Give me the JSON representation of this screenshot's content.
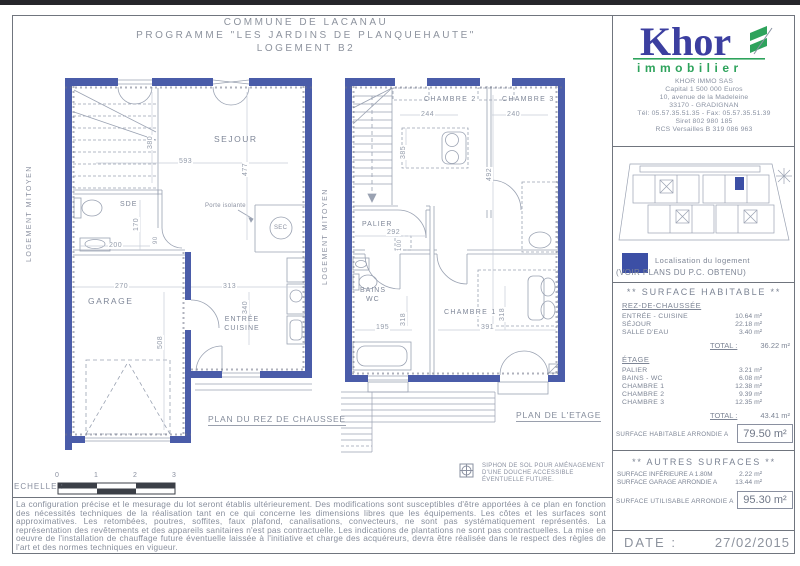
{
  "colors": {
    "wall_blue": "#4a5ca9",
    "logo_blue": "#3c3fa0",
    "logo_green": "#2ea35c",
    "localisation_blue": "#3c4fa5",
    "scale_dark": "#3b3f47"
  },
  "header": {
    "line1": "COMMUNE DE LACANAU",
    "line2": "PROGRAMME \"LES JARDINS DE PLANQUEHAUTE\"",
    "line3": "LOGEMENT B2"
  },
  "ground_plan": {
    "title": "PLAN DU REZ DE CHAUSSEE",
    "party_wall": "LOGEMENT MITOYEN",
    "rooms": {
      "sejour": "SEJOUR",
      "sde": "SDE",
      "garage": "GARAGE",
      "entree": "ENTRÉE",
      "cuisine": "CUISINE",
      "sec": "SEC"
    },
    "notes": {
      "porte_isolante": "Porte isolante"
    },
    "dims": {
      "d380": "380",
      "d593": "593",
      "d477": "477",
      "d170": "170",
      "d200": "200",
      "d90": "90",
      "d270": "270",
      "d313": "313",
      "d340": "340",
      "d508": "508"
    }
  },
  "floor_plan": {
    "title": "PLAN DE L'ETAGE",
    "party_wall": "LOGEMENT MITOYEN",
    "rooms": {
      "chambre1": "CHAMBRE 1",
      "chambre2": "CHAMBRE 2",
      "chambre3": "CHAMBRE 3",
      "palier": "PALIER",
      "bains": "BAINS",
      "wc": "WC"
    },
    "dims": {
      "d244": "244",
      "d240": "240",
      "d385": "385",
      "d492": "492",
      "d292": "292",
      "d100": "100",
      "d318": "318",
      "d195": "195",
      "d391": "391",
      "d318b": "318"
    }
  },
  "scale_bar": {
    "label": "ECHELLE :",
    "ticks": [
      "0",
      "1",
      "2",
      "3"
    ]
  },
  "siphon_note": {
    "line1": "SIPHON DE SOL POUR AMÉNAGEMENT",
    "line2": "D'UNE DOUCHE ACCESSIBLE",
    "line3": "ÉVENTUELLE  FUTURE."
  },
  "legal_text": "La configuration précise et le mesurage du lot seront établis ultérieurement. Des modifications sont susceptibles d'être apportées à ce plan en fonction des nécessités techniques de la réalisation tant en ce qui concerne les dimensions libres que les équipements. Les côtes et les surfaces sont approximatives. Les retombées, poutres, soffites, faux plafond, canalisations, convecteurs, ne sont pas systématiquement représentés. La représentation des revêtements et des appareils sanitaires n'est pas contractuelle. Les indications de plantations ne sont pas contractuelles. La mise en oeuvre de l'installation de chauffage future éventuelle laissée à l'initiative et charge des acquéreurs, devra être réalisée dans le respect des règles de l'art et des normes techniques en vigueur.",
  "sidebar": {
    "logo": {
      "brand": "Khor",
      "tagline": "immobilier"
    },
    "company": {
      "lines": [
        "KHOR IMMO SAS",
        "Capital 1 500 000 Euros",
        "10, avenue de la Madeleine",
        "33170 - GRADIGNAN",
        "Tél: 05.57.35.51.35 - Fax: 05.57.35.51.39",
        "Siret 802 980 185",
        "RCS Versailles B 319 086 963"
      ]
    },
    "localisation": {
      "line1": "Localisation du logement",
      "line2": "(VOIR PLANS DU P.C. OBTENU)"
    },
    "surface_habitable": {
      "title": "** SURFACE HABITABLE **",
      "rdc_heading": "REZ-DE-CHAUSSÉE",
      "rdc_rows": [
        {
          "label": "ENTRÉE - CUISINE",
          "value": "10.64 m²"
        },
        {
          "label": "SÉJOUR",
          "value": "22.18 m²"
        },
        {
          "label": "SALLE D'EAU",
          "value": "3.40 m²"
        }
      ],
      "total_label": "TOTAL :",
      "rdc_total": "36.22 m²",
      "etage_heading": "ÉTAGE",
      "etage_rows": [
        {
          "label": "PALIER",
          "value": "3.21 m²"
        },
        {
          "label": "BAINS - WC",
          "value": "6.08 m²"
        },
        {
          "label": "CHAMBRE 1",
          "value": "12.38 m²"
        },
        {
          "label": "CHAMBRE 2",
          "value": "9.39 m²"
        },
        {
          "label": "CHAMBRE 3",
          "value": "12.35 m²"
        }
      ],
      "etage_total": "43.41 m²",
      "rounded_label": "SURFACE HABITABLE ARRONDIE A",
      "rounded_value": "79.50 m²"
    },
    "autres_surfaces": {
      "title": "** AUTRES SURFACES **",
      "rows": [
        {
          "label": "SURFACE INFÉRIEURE A 1.80M",
          "value": "2.22 m²"
        },
        {
          "label": "SURFACE GARAGE ARRONDIE A",
          "value": "13.44 m²"
        }
      ],
      "usable_label": "SURFACE UTILISABLE ARRONDIE A",
      "usable_value": "95.30 m²"
    },
    "date": {
      "label": "DATE :",
      "value": "27/02/2015"
    }
  }
}
